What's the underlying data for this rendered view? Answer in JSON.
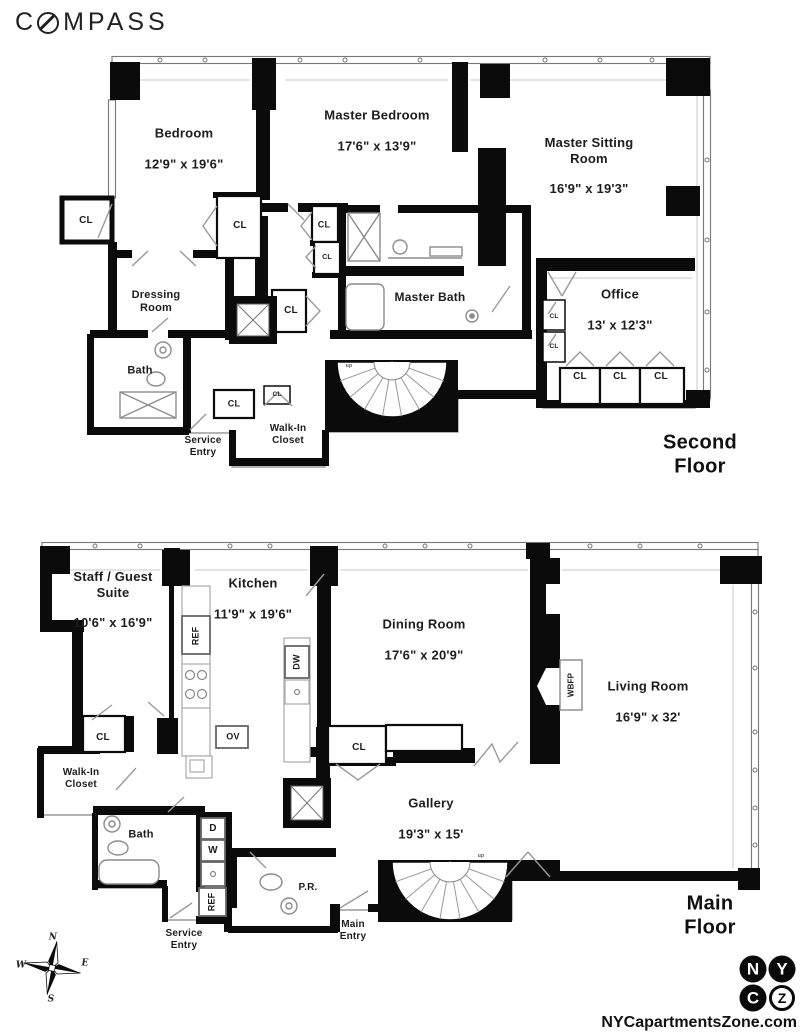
{
  "brand": {
    "parts": [
      "C",
      "MPASS"
    ]
  },
  "labels": {
    "closet": "CL",
    "up": "up"
  },
  "second_floor": {
    "title": "Second Floor",
    "bedroom": {
      "name": "Bedroom",
      "dims": "12'9\" x 19'6\""
    },
    "master_bedroom": {
      "name": "Master Bedroom",
      "dims": "17'6\" x 13'9\""
    },
    "master_sitting": {
      "name": "Master Sitting\nRoom",
      "dims": "16'9\" x 19'3\""
    },
    "office": {
      "name": "Office",
      "dims": "13' x 12'3\""
    },
    "master_bath": {
      "name": "Master Bath"
    },
    "dressing": {
      "name": "Dressing\nRoom"
    },
    "bath": {
      "name": "Bath"
    },
    "service_entry": {
      "name": "Service\nEntry"
    },
    "walk_in": {
      "name": "Walk-In\nCloset"
    }
  },
  "main_floor": {
    "title": "Main Floor",
    "staff": {
      "name": "Staff / Guest\nSuite",
      "dims": "10'6\" x 16'9\""
    },
    "kitchen": {
      "name": "Kitchen",
      "dims": "11'9\" x 19'6\""
    },
    "dining": {
      "name": "Dining Room",
      "dims": "17'6\" x 20'9\""
    },
    "living": {
      "name": "Living Room",
      "dims": "16'9\" x 32'"
    },
    "gallery": {
      "name": "Gallery",
      "dims": "19'3\" x 15'"
    },
    "walk_in": {
      "name": "Walk-In\nCloset"
    },
    "bath": {
      "name": "Bath"
    },
    "powder_room": {
      "name": "P.R."
    },
    "service_entry": {
      "name": "Service\nEntry"
    },
    "main_entry": {
      "name": "Main\nEntry"
    }
  },
  "appliances": {
    "ref": "REF",
    "ov": "OV",
    "dw": "DW",
    "d": "D",
    "w": "W",
    "wbfp": "WBFP"
  },
  "compass_rose": {
    "n": "N",
    "e": "E",
    "s": "S",
    "w": "W"
  },
  "footer": {
    "logo_letters": [
      "N",
      "Y",
      "C",
      "Z"
    ],
    "site": "NYCapartmentsZone.com"
  }
}
